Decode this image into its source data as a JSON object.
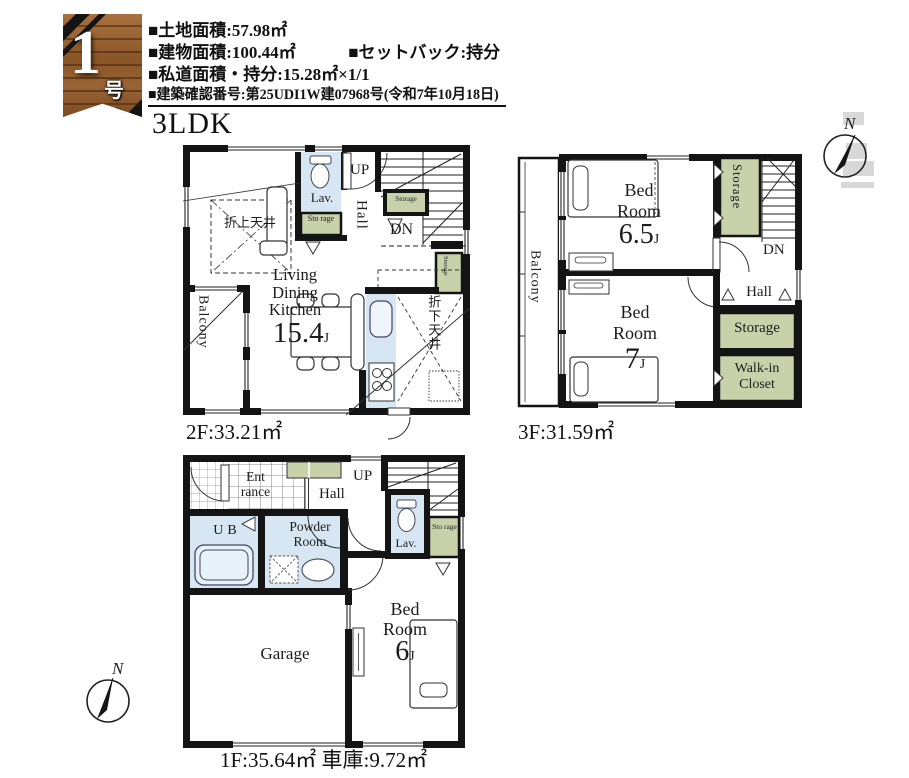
{
  "badge": {
    "number": "1",
    "suffix": "号棟"
  },
  "header": {
    "land_area": "■土地面積:57.98㎡",
    "building_area": "■建物面積:100.44㎡",
    "setback": "■セットバック:持分",
    "private_road": "■私道面積・持分:15.28㎡×1/1",
    "confirmation": "■建築確認番号:第25UDI1W建07968号(令和7年10月18日)"
  },
  "title": "3LDK",
  "compass": {
    "north": "N"
  },
  "floor2": {
    "area_label": "2F:33.21㎡",
    "living": "Living",
    "dining": "Dining",
    "kitchen": "Kitchen",
    "ldk_size": "15.4",
    "ldk_unit": "J",
    "lav": "Lav.",
    "up": "UP",
    "dn": "DN",
    "hall": "Hall",
    "storage_small": "Sto rage",
    "storage_stairs": "Storage",
    "storage_side": "Storage",
    "balcony": "Balcony",
    "raised_ceiling": "折上天井",
    "dropped_ceiling": "折下天井"
  },
  "floor3": {
    "area_label": "3F:31.59㎡",
    "bed1_l1": "Bed",
    "bed1_l2": "Room",
    "bed1_size": "6.5",
    "bed1_unit": "J",
    "bed2_l1": "Bed",
    "bed2_l2": "Room",
    "bed2_size": "7",
    "bed2_unit": "J",
    "balcony": "Balcony",
    "hall": "Hall",
    "dn": "DN",
    "storage_top": "Storage",
    "storage_right": "Storage",
    "wic_l1": "Walk-in",
    "wic_l2": "Closet"
  },
  "floor1": {
    "area_label": "1F:35.64㎡ 車庫:9.72㎡",
    "entrance_l1": "Ent",
    "entrance_l2": "rance",
    "hall": "Hall",
    "up": "UP",
    "ub": "UB",
    "powder_l1": "Powder",
    "powder_l2": "Room",
    "lav": "Lav.",
    "storage": "Sto rage",
    "garage": "Garage",
    "bed_l1": "Bed",
    "bed_l2": "Room",
    "bed_size": "6",
    "bed_unit": "J"
  }
}
